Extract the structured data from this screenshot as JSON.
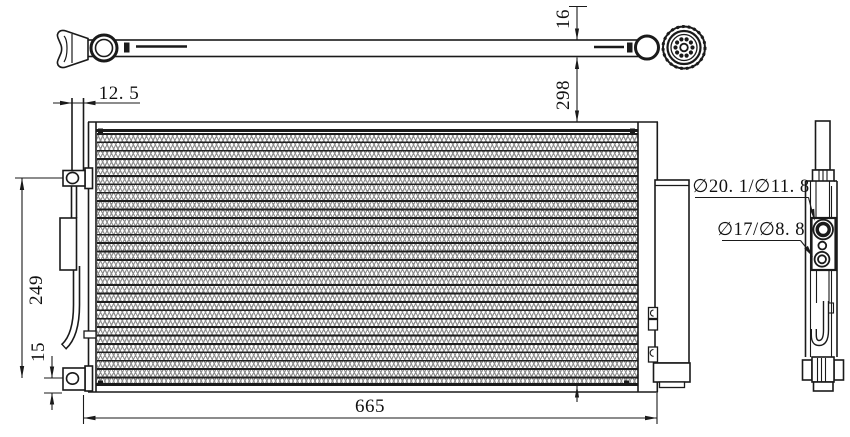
{
  "drawing": {
    "kind": "condenser-technical-drawing",
    "line_color": "#1a1a1a",
    "dimensions": {
      "core_width": "665",
      "bracket_span": "249",
      "tube_depth": "16",
      "header_offset": "12. 5",
      "inlet_drop": "298",
      "foot_offset": "15"
    },
    "port_labels": {
      "upper": "∅20. 1/∅11. 8",
      "lower": "∅17/∅8. 8"
    }
  }
}
